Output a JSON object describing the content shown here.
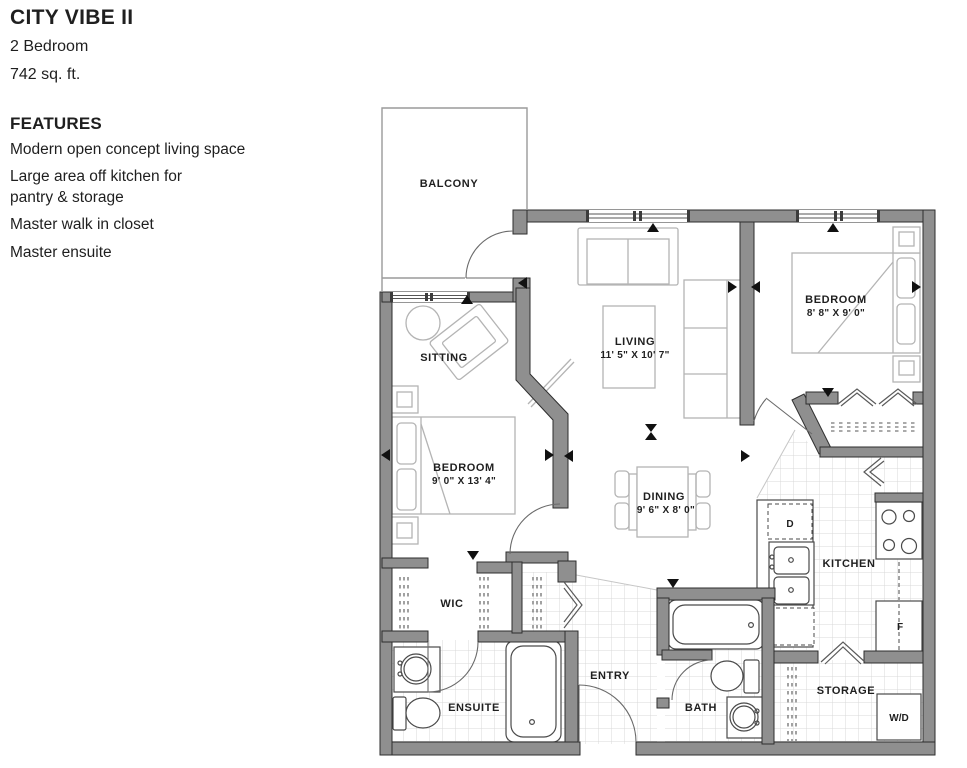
{
  "header": {
    "title": "CITY VIBE II",
    "subtitle_lines": [
      "2 Bedroom",
      "742 sq. ft."
    ]
  },
  "features": {
    "heading": "FEATURES",
    "items": [
      "Modern open concept living space",
      "Large area off kitchen for\npantry & storage",
      "Master walk in closet",
      "Master ensuite"
    ]
  },
  "rooms": {
    "balcony": {
      "name": "BALCONY"
    },
    "sitting": {
      "name": "SITTING"
    },
    "living": {
      "name": "LIVING",
      "dims": "11' 5\" X 10' 7\""
    },
    "bedroom_right": {
      "name": "BEDROOM",
      "dims": "8' 8\" X 9' 0\""
    },
    "bedroom_left": {
      "name": "BEDROOM",
      "dims": "9' 0\" X 13' 4\""
    },
    "dining": {
      "name": "DINING",
      "dims": "9' 6\" X 8' 0\""
    },
    "kitchen": {
      "name": "KITCHEN"
    },
    "wic": {
      "name": "WIC"
    },
    "ensuite": {
      "name": "ENSUITE"
    },
    "entry": {
      "name": "ENTRY"
    },
    "bath": {
      "name": "BATH"
    },
    "storage": {
      "name": "STORAGE"
    }
  },
  "appliances": {
    "dishwasher": "D",
    "fridge": "F",
    "washer_dryer": "W/D"
  },
  "colors": {
    "wall": "#8f8f8f",
    "wall_outline": "#2e2e2e",
    "fixture_line": "#4a4a4a",
    "furniture_line": "#b4b4b4",
    "tile_line": "#d8d8d8",
    "text": "#1f1f1f",
    "background": "#ffffff"
  }
}
